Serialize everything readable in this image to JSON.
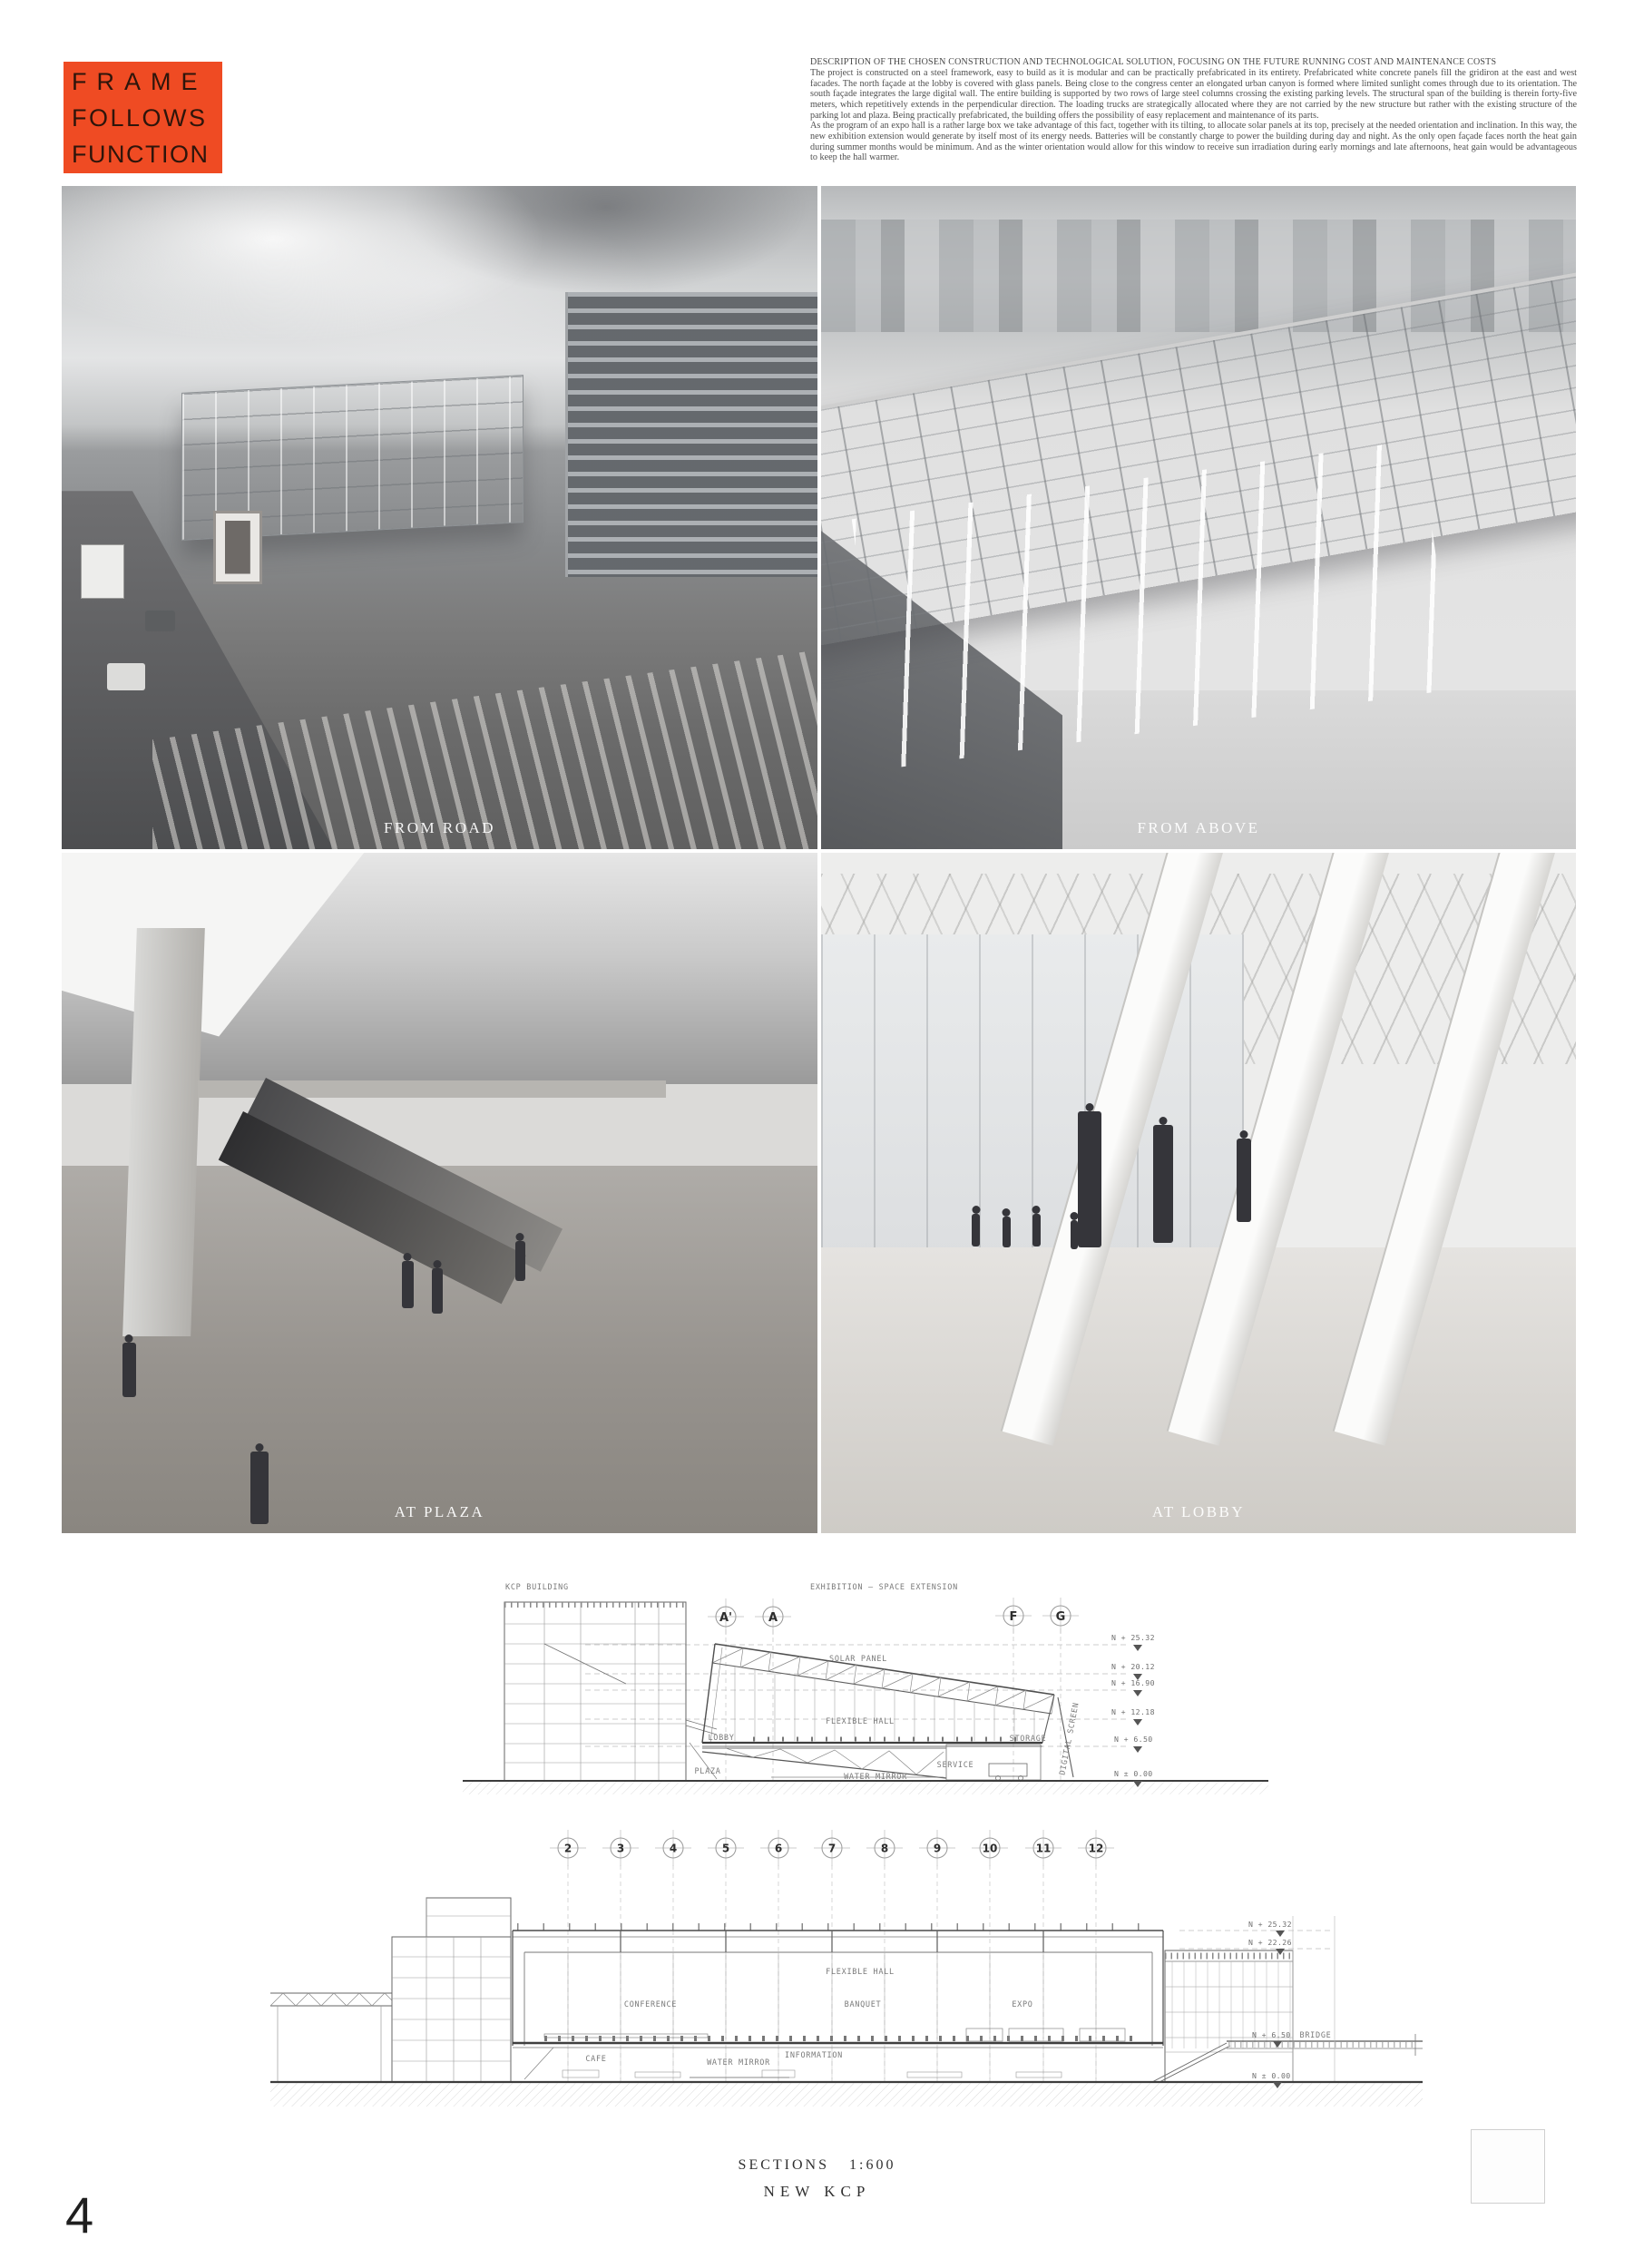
{
  "accent_color": "#EF4B23",
  "logo": {
    "lines": [
      "FRAME",
      "FOLLOWS",
      "FUNCTION"
    ]
  },
  "description": {
    "heading": "DESCRIPTION OF THE CHOSEN CONSTRUCTION AND TECHNOLOGICAL SOLUTION, FOCUSING ON THE FUTURE RUNNING COST AND MAINTENANCE COSTS",
    "para1": "The project is constructed on a steel framework, easy to build as it is modular and can be practically prefabricated in its entirety. Prefabricated white concrete panels fill the gridiron at the east and west facades. The north façade at the lobby is covered with glass panels. Being close to the congress center an elongated urban canyon is formed where limited sunlight comes through due to its orientation. The south façade integrates the large digital wall. The entire building is supported by two rows of large steel columns crossing the existing parking levels. The structural span of the building is therein forty-five meters, which repetitively extends in the perpendicular direction. The loading trucks are strategically allocated where they are not carried by the new structure but rather with the existing structure of the parking lot and plaza. Being practically prefabricated, the building offers the possibility of easy replacement and maintenance of its parts.",
    "para2": "As the program of an expo hall is a rather large box we take advantage of this fact, together with its tilting, to allocate solar panels at its top, precisely at the needed orientation and inclination. In this way, the new exhibition extension would generate by itself most of its energy needs. Batteries will be constantly charge to power the building during day and night. As the only open façade faces north the heat gain during summer months would be minimum. And as the winter orientation would allow for this window to receive sun irradiation during early mornings and late afternoons, heat gain would be advantageous to keep the hall warmer."
  },
  "photos": [
    {
      "caption": "FROM ROAD"
    },
    {
      "caption": "FROM ABOVE"
    },
    {
      "caption": "AT PLAZA"
    },
    {
      "caption": "AT LOBBY"
    }
  ],
  "section1": {
    "kcp_label": "KCP BUILDING",
    "extension_label": "EXHIBITION  –  SPACE EXTENSION",
    "bubbles": [
      "A'",
      "A",
      "F",
      "G"
    ],
    "levels": [
      "N + 25.32",
      "N + 20.12",
      "N + 16.90",
      "N + 12.18",
      "N + 6.50",
      "N ± 0.00"
    ],
    "rooms": {
      "solar_panel": "SOLAR PANEL",
      "flexible_hall": "FLEXIBLE HALL",
      "lobby": "LOBBY",
      "plaza": "PLAZA",
      "water_mirror": "WATER MIRROR",
      "service": "SERVICE",
      "storage": "STORAGE",
      "digital_screen": "DIGITAL SCREEN"
    }
  },
  "section2": {
    "bubbles": [
      "2",
      "3",
      "4",
      "5",
      "6",
      "7",
      "8",
      "9",
      "10",
      "11",
      "12"
    ],
    "levels": [
      "N + 25.32",
      "N + 22.26",
      "N + 6.50",
      "N ± 0.00"
    ],
    "rooms": {
      "flexible_hall": "FLEXIBLE HALL",
      "conference": "CONFERENCE",
      "banquet": "BANQUET",
      "expo": "EXPO",
      "cafe": "CAFE",
      "water_mirror": "WATER MIRROR",
      "information": "INFORMATION",
      "bridge": "BRIDGE"
    }
  },
  "footer": {
    "sections_label": "SECTIONS",
    "scale": "1:600",
    "project": "NEW KCP",
    "page_number": "4"
  }
}
